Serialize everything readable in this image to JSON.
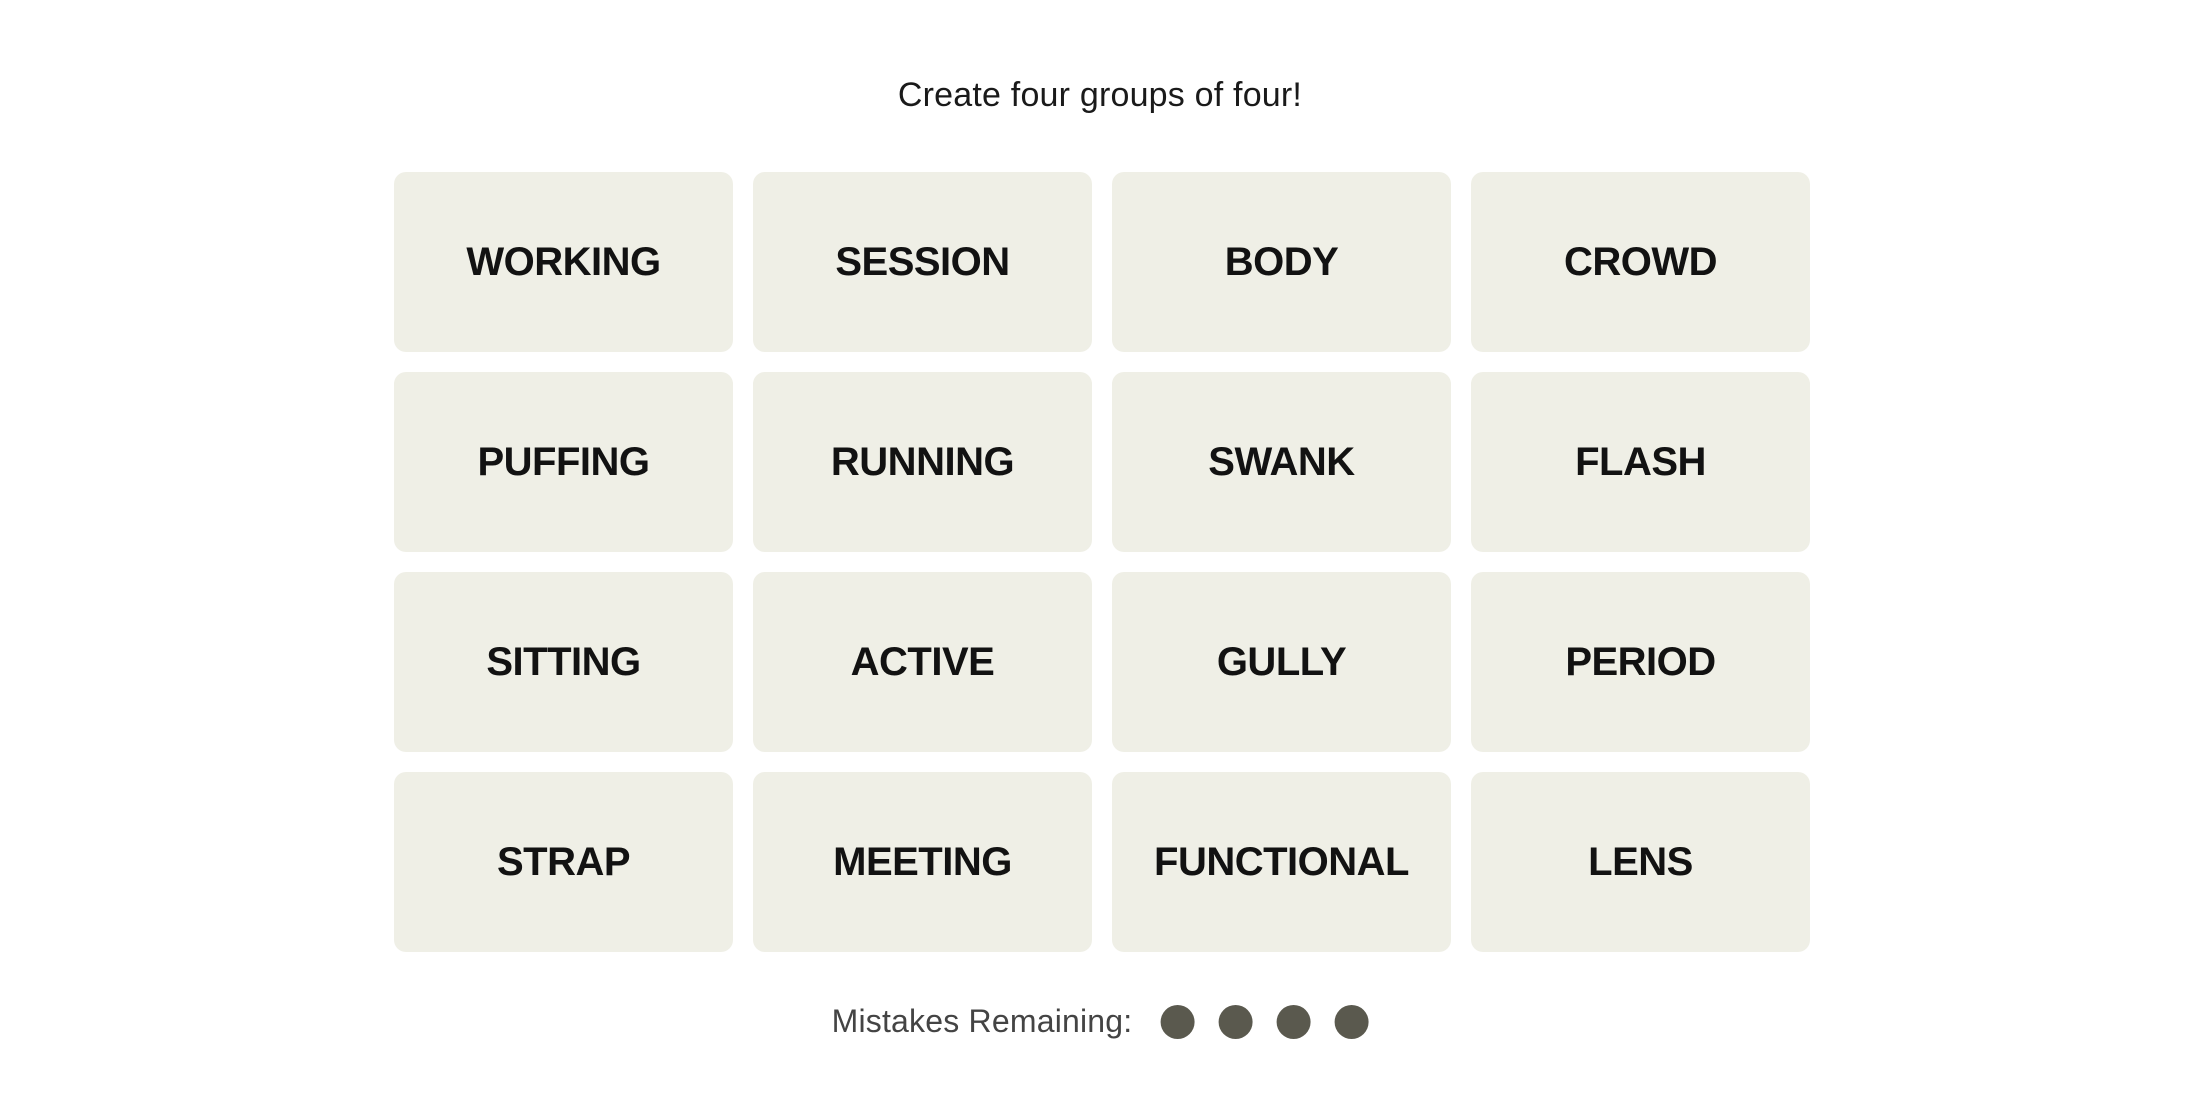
{
  "title": "Create four groups of four!",
  "board": {
    "tiles": [
      "WORKING",
      "SESSION",
      "BODY",
      "CROWD",
      "PUFFING",
      "RUNNING",
      "SWANK",
      "FLASH",
      "SITTING",
      "ACTIVE",
      "GULLY",
      "PERIOD",
      "STRAP",
      "MEETING",
      "FUNCTIONAL",
      "LENS"
    ]
  },
  "mistakes": {
    "label": "Mistakes Remaining:",
    "remaining": 4
  },
  "colors": {
    "page_bg": "#ffffff",
    "tile_bg": "#efefe6",
    "tile_text": "#121212",
    "mistake_dot": "#5a594e",
    "label_text": "#444444"
  }
}
